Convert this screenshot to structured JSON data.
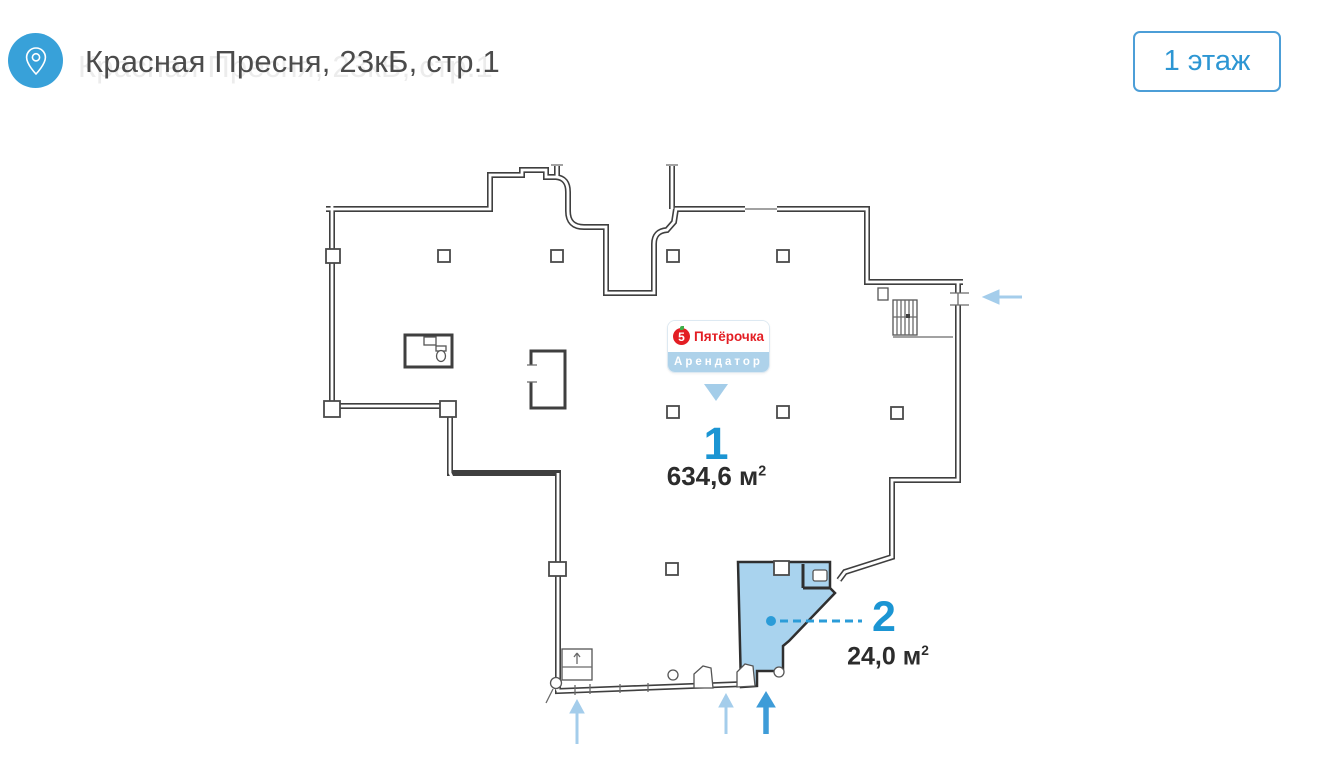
{
  "header": {
    "title": "Красная Пресня, 23кБ, стр.1",
    "floor_selector": "1 этаж"
  },
  "tenant_badge": {
    "logo_digit": "5",
    "brand": "Пятёрочка",
    "role": "Арендатор"
  },
  "units": [
    {
      "number": "1",
      "area": "634,6 м",
      "area_sup": "2"
    },
    {
      "number": "2",
      "area": "24,0 м",
      "area_sup": "2"
    }
  ],
  "icons": {
    "header_icon": "location-pin-icon",
    "entrance_markers": "entrance-arrow-icons"
  },
  "colors": {
    "accent_blue": "#1b95d3",
    "header_icon_bg": "#38a1d9",
    "button_border": "#4c9ed7",
    "unit_highlight_fill": "#a9d3ee",
    "arrow_light": "#a4cdeb",
    "arrow_dark": "#3e9cd8",
    "brand_red": "#e31e24",
    "badge_strip": "#aed2ea",
    "walls": "#3f3f3f"
  }
}
